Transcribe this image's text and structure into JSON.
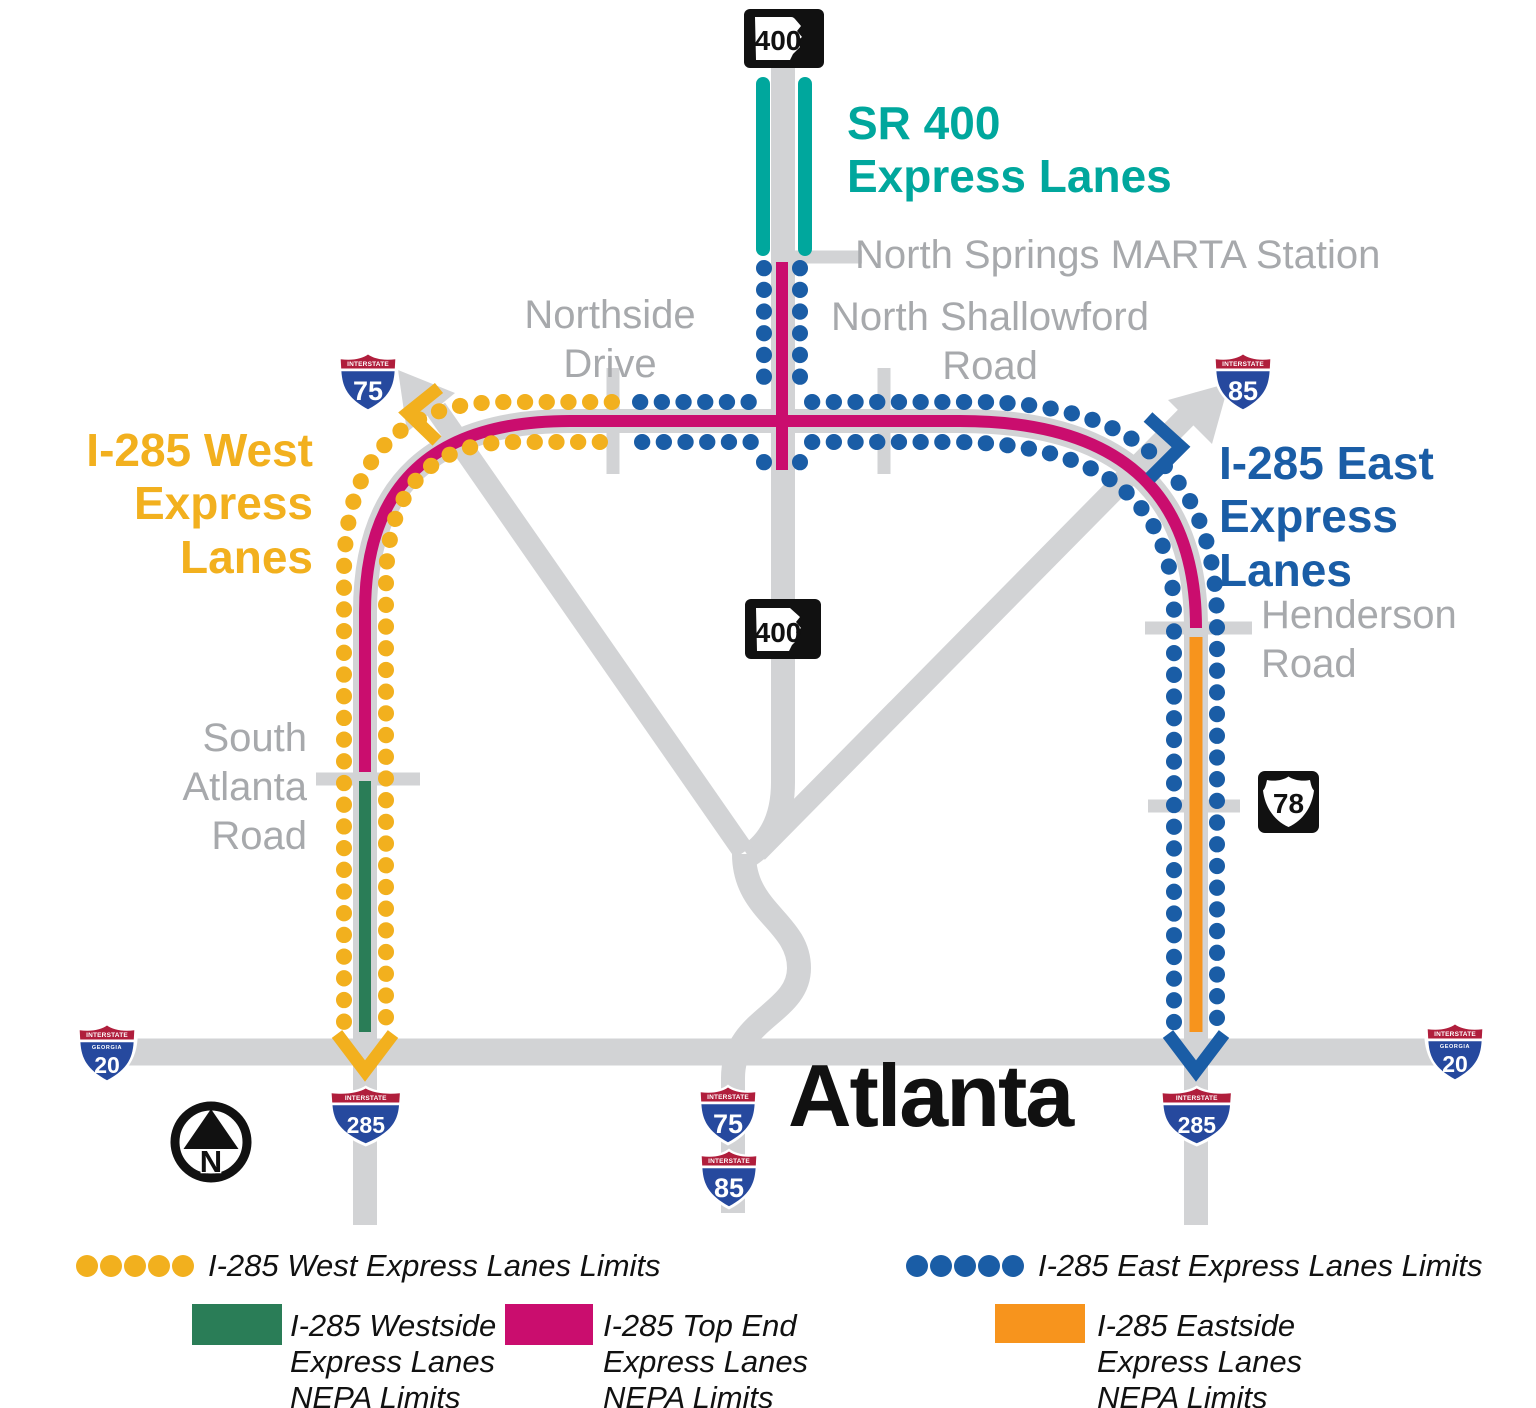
{
  "colors": {
    "teal": "#00A79D",
    "yellow": "#F2B01E",
    "blue": "#1A5DA6",
    "pink": "#CA0D6E",
    "green": "#2A7D57",
    "orange": "#F7941D",
    "road": "#D2D3D5",
    "label_gray": "#A7A9AC",
    "shield_red": "#B01E3C",
    "shield_blue": "#26499E"
  },
  "map": {
    "labels": {
      "sr400": "SR 400\nExpress Lanes",
      "north_springs": "North Springs MARTA Station",
      "northside": "Northside\nDrive",
      "shallowford": "North Shallowford\nRoad",
      "i285_west": "I-285 West\nExpress Lanes",
      "i285_east": "I-285 East\nExpress Lanes",
      "henderson": "Henderson\nRoad",
      "south_atlanta": "South\nAtlanta\nRoad",
      "city": "Atlanta"
    },
    "shields": {
      "interstate": "INTERSTATE",
      "georgia": "GEORGIA",
      "sr400_top": "400",
      "sr400_mid": "400",
      "i75_top": "75",
      "i85_top": "85",
      "us78": "78",
      "i20_left": "20",
      "i20_right": "20",
      "i285_bottom_west": "285",
      "i285_bottom_east": "285",
      "i75_bottom": "75",
      "i85_bottom": "85"
    },
    "compass": {
      "north": "N"
    }
  },
  "legend": {
    "west_limits": "I-285 West Express Lanes Limits",
    "east_limits": "I-285 East Express Lanes Limits",
    "westside_nepa": "I-285 Westside\nExpress Lanes\nNEPA Limits",
    "top_end_nepa": "I-285 Top End\nExpress Lanes\nNEPA Limits",
    "eastside_nepa": "I-285 Eastside\nExpress Lanes\nNEPA Limits"
  }
}
